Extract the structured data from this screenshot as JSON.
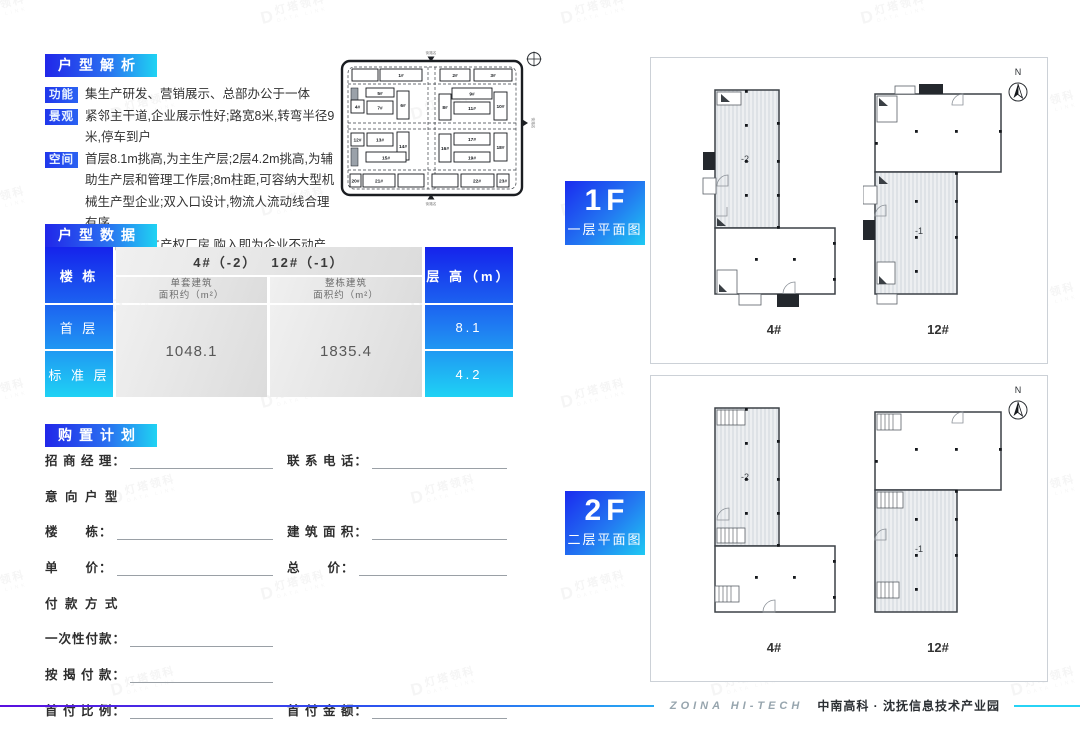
{
  "page": {
    "brand_en": "ZOINA HI-TECH",
    "brand_cn": "中南高科 · 沈抚信息技术产业园"
  },
  "watermark": {
    "logo": "D",
    "text": "灯塔领科",
    "subtext": "DATA LINK"
  },
  "analysis": {
    "title": "户型解析",
    "items": [
      {
        "tag": "功能",
        "text": "集生产研发、营销展示、总部办公于一体"
      },
      {
        "tag": "景观",
        "text": "紧邻主干道,企业展示性好;路宽8米,转弯半径9米,停车到户"
      },
      {
        "tag": "空间",
        "text": "首层8.1m挑高,为主生产层;2层4.2m挑高,为辅助生产层和管理工作层;8m柱距,可容纳大型机械生产型企业;双入口设计,物流人流动线合理有序"
      },
      {
        "tag": "价值",
        "text": "市场罕有独立产权厂房,购入即为企业不动产"
      }
    ]
  },
  "sitemap": {
    "road_top": "街路名",
    "road_right": "街路名",
    "road_bottom": "街路名",
    "buildings": {
      "b1": "1#",
      "b2": "2#",
      "b3": "3#",
      "b4": "4#",
      "b5": "5#",
      "b6": "6#",
      "b7": "7#",
      "b8": "8#",
      "b9": "9#",
      "b10": "10#",
      "b11": "11#",
      "b12": "12#",
      "b13": "13#",
      "b14": "14#",
      "b15": "15#",
      "b16": "16#",
      "b17": "17#",
      "b18": "18#",
      "b19": "19#",
      "b20": "20#",
      "b21": "21#",
      "b22": "22#",
      "b23": "23#"
    }
  },
  "data_table": {
    "title": "户型数据",
    "row_header": "楼  栋",
    "row1": "首  层",
    "row2": "标 准 层",
    "span_header": "4#（-2）　 12#（-1）",
    "col1_header_l1": "单套建筑",
    "col1_header_l2": "面积约（m²）",
    "col2_header_l1": "整栋建筑",
    "col2_header_l2": "面积约（m²）",
    "col1_value": "1048.1",
    "col2_value": "1835.4",
    "height_header": "层 高（m）",
    "height1": "8.1",
    "height2": "4.2"
  },
  "purchase_form": {
    "title": "购置计划",
    "manager_label": "招 商 经 理：",
    "phone_label": "联 系 电 话：",
    "intent_title": "意 向 户 型",
    "building_label": "楼　　栋：",
    "area_label": "建 筑 面 积：",
    "unit_price_label": "单　　价：",
    "total_price_label": "总　　价：",
    "payment_title": "付 款 方 式",
    "once_label": "一次性付款：",
    "mortgage_label": "按 揭 付 款：",
    "down_ratio_label": "首 付 比 例：",
    "down_amount_label": "首 付 金 额：",
    "loan_label": "贷 款 金 额：",
    "monthly_label": "月　　供："
  },
  "plans": {
    "compass": "N",
    "f1": {
      "num": "1F",
      "caption": "一层平面图",
      "b1": {
        "name": "4#",
        "unit": "-2"
      },
      "b2": {
        "name": "12#",
        "unit": "-1"
      }
    },
    "f2": {
      "num": "2F",
      "caption": "二层平面图",
      "b1": {
        "name": "4#",
        "unit": "-2"
      },
      "b2": {
        "name": "12#",
        "unit": "-1"
      }
    }
  }
}
